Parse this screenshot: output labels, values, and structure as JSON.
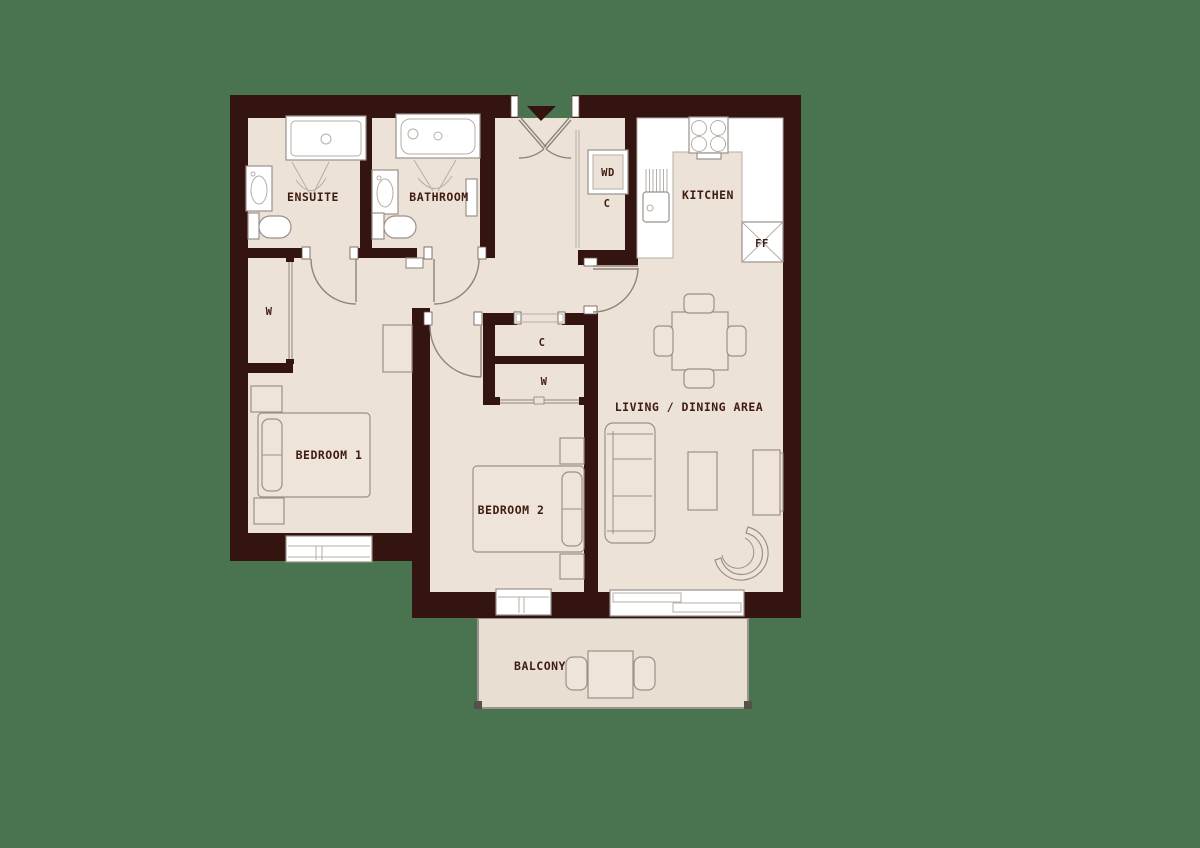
{
  "floorplan": {
    "rooms": {
      "ensuite": "ENSUITE",
      "bathroom": "BATHROOM",
      "kitchen": "KITCHEN",
      "bedroom1": "BEDROOM 1",
      "bedroom2": "BEDROOM 2",
      "living_dining": "LIVING / DINING AREA",
      "balcony": "BALCONY"
    },
    "features": {
      "washer_dryer": "WD",
      "hall_cupboard": "C",
      "fridge_freezer": "FF",
      "bedroom1_wardrobe": "W",
      "corridor_cupboard": "C",
      "bedroom2_wardrobe": "W"
    },
    "colors": {
      "background": "#4A7450",
      "wall": "#331410",
      "floor": "#EDE2D7",
      "balcony_floor": "#E9DED2",
      "fixture_white": "#FFFFFF",
      "outline_gray": "#9A9189",
      "label_text": "#3E1C12"
    }
  }
}
